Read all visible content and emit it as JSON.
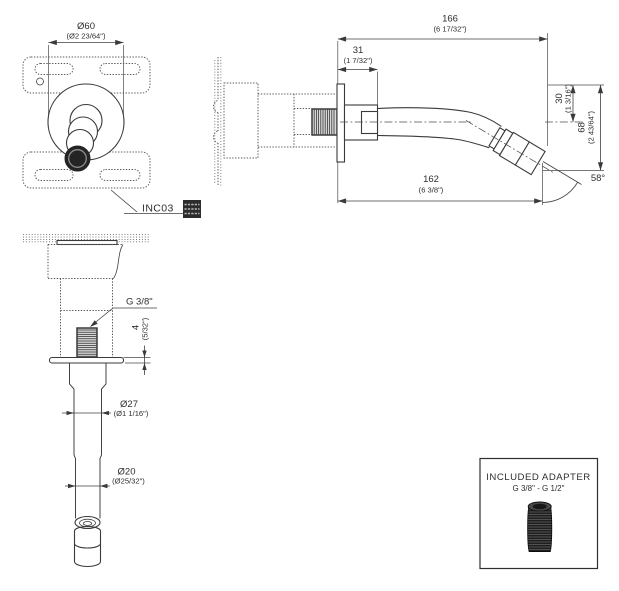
{
  "drawing": {
    "front_view": {
      "dim_diameter": {
        "mm": "Ø60",
        "inch": "(Ø2 23/64\")"
      },
      "ref_label": "INC03"
    },
    "side_view": {
      "dim_total_length": {
        "mm": "166",
        "inch": "(6 17/32\")"
      },
      "dim_base_length": {
        "mm": "31",
        "inch": "(1 7/32\")"
      },
      "dim_drop_top": {
        "mm": "30",
        "inch": "(1 3/16\")"
      },
      "dim_drop_total": {
        "mm": "68",
        "inch": "(2 43/64\")"
      },
      "dim_spout_reach": {
        "mm": "162",
        "inch": "(6 3/8\")"
      },
      "spout_angle": "58°"
    },
    "section_view": {
      "thread_label": "G 3/8\"",
      "dim_flange": {
        "mm": "4",
        "inch": "(5/32\")"
      },
      "dim_upper_dia": {
        "mm": "Ø27",
        "inch": "(Ø1 1/16\")"
      },
      "dim_tube_dia": {
        "mm": "Ø20",
        "inch": "(Ø25/32\")"
      }
    },
    "adapter_box": {
      "title": "INCLUDED ADAPTER",
      "subtitle": "G 3/8\" - G 1/2\""
    },
    "colors": {
      "line": "#3a3a3a",
      "stipple": "#5a5a5a",
      "text": "#2e2e2e",
      "dark_fill": "#1f1f1f",
      "background": "#ffffff"
    }
  }
}
